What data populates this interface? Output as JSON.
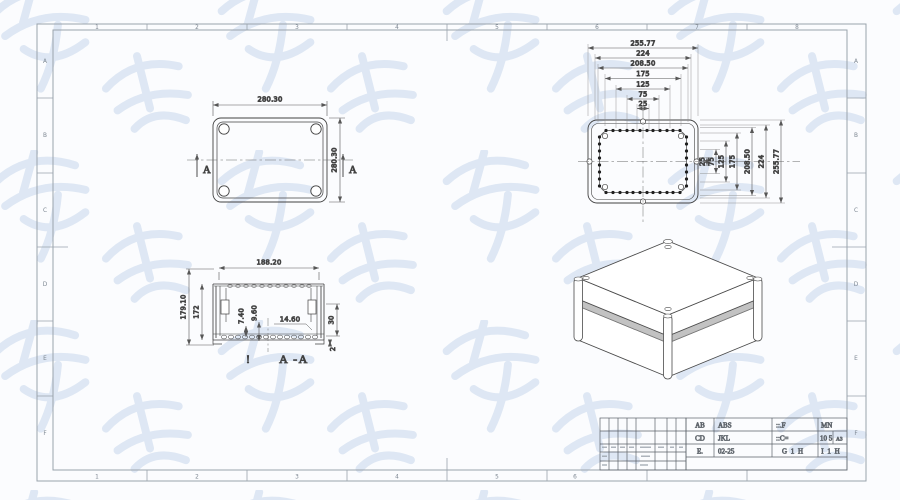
{
  "sheet": {
    "type": "cad-engineering-drawing",
    "format_note": "A3"
  },
  "colors": {
    "geometry_line": "#424242",
    "dimension_line": "#565656",
    "frame_line": "#9aa3ac",
    "watermark": "#d5e1f0",
    "seam_band": "#c2c2c2",
    "hole_dot": "#1f1f1f",
    "background": "#fbfcfe"
  },
  "frame": {
    "top_zones": [
      "1",
      "2",
      "3",
      "4",
      "5",
      "6",
      "7",
      "8"
    ],
    "bottom_zones": [
      "1",
      "2",
      "3",
      "4",
      "5",
      "6",
      "7",
      "8"
    ],
    "left_zones": [
      "A",
      "B",
      "C",
      "D",
      "E",
      "F"
    ],
    "right_zones": [
      "A",
      "B",
      "C",
      "D",
      "E",
      "F"
    ]
  },
  "top_view": {
    "dim_width": "280.30",
    "dim_height": "280.30",
    "section_label": "A"
  },
  "section_view": {
    "label": "A -A",
    "note": "!",
    "dim_width": "188.20",
    "dim_height_outer": "179.10",
    "dim_height_inner": "172",
    "dim_rib_small": "7.40",
    "dim_rib_large": "9.60",
    "dim_boss": "14.60",
    "dim_lip": "30",
    "dim_base": "2"
  },
  "hole_view": {
    "top_dims": [
      "255.77",
      "224",
      "208.50",
      "175",
      "125",
      "75",
      "25"
    ],
    "right_dims": [
      "25",
      "75",
      "125",
      "175",
      "208.50",
      "224",
      "255.77"
    ]
  },
  "title_block": {
    "r1c1": "AB",
    "r1c2": "ABS",
    "r1c3": "::.F",
    "r1c4": "MN",
    "r2c1": "CD",
    "r2c2": "JKL",
    "r2c3": "::C=",
    "r2c4": "10 5",
    "r2c5": "A3",
    "r3c1": "E.",
    "r3c2": "02-25",
    "r3c3": "G 1 H",
    "r3c4": "I 1 H"
  }
}
